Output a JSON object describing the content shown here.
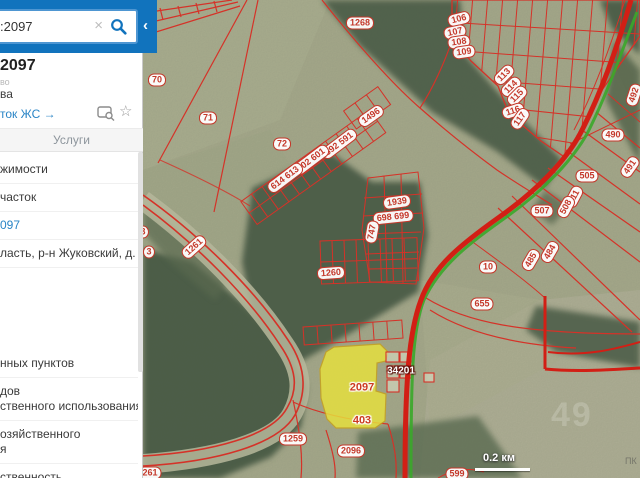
{
  "sidebar": {
    "search": {
      "value": ":2097",
      "clear_icon": "×",
      "collapse_icon": "‹"
    },
    "result": {
      "title": "2097",
      "meta": "во",
      "line2": "ва",
      "link": "ток ЖС →",
      "star_icon": "☆"
    },
    "tab": "Услуги",
    "rows_top": [
      {
        "lines": [
          "жимости"
        ]
      },
      {
        "lines": [
          "часток"
        ]
      },
      {
        "lines": [
          "097"
        ],
        "link": true
      },
      {
        "lines": [
          "ласть, р-н Жуковский, д."
        ]
      }
    ],
    "rows_bottom": [
      {
        "lines": [
          "нных пунктов"
        ]
      },
      {
        "lines": [
          "дов",
          "ственного использования"
        ]
      },
      {
        "lines": [
          "озяйственного",
          "я"
        ]
      },
      {
        "lines": [
          "ственность"
        ]
      }
    ]
  },
  "map": {
    "scale": {
      "label": "0.2 км"
    },
    "watermark": {
      "digits": "49",
      "corner": "ПК"
    },
    "colors": {
      "accent_blue": "#1173bd",
      "parcel_red": "#d53228",
      "highlight_yellow": "#e8e23c",
      "road_green": "#3aa82a"
    },
    "labels": [
      {
        "text": "1268",
        "x": 217,
        "y": 23
      },
      {
        "text": "70",
        "x": 14,
        "y": 80
      },
      {
        "text": "71",
        "x": 65,
        "y": 118
      },
      {
        "text": "72",
        "x": 139,
        "y": 144
      },
      {
        "text": "106",
        "x": 316,
        "y": 19,
        "r": -14
      },
      {
        "text": "107",
        "x": 312,
        "y": 32,
        "r": -12
      },
      {
        "text": "108",
        "x": 316,
        "y": 42,
        "r": -8
      },
      {
        "text": "109",
        "x": 321,
        "y": 52,
        "r": -8
      },
      {
        "text": "113",
        "x": 361,
        "y": 75,
        "r": -45
      },
      {
        "text": "114",
        "x": 368,
        "y": 87,
        "r": -45
      },
      {
        "text": "115",
        "x": 374,
        "y": 96,
        "r": -45
      },
      {
        "text": "116",
        "x": 370,
        "y": 111,
        "r": -18
      },
      {
        "text": "117",
        "x": 377,
        "y": 119,
        "r": -55
      },
      {
        "text": "1496",
        "x": 228,
        "y": 116,
        "r": -35
      },
      {
        "text": "592 591",
        "x": 196,
        "y": 144,
        "r": -37
      },
      {
        "text": "602 601",
        "x": 168,
        "y": 160,
        "r": -37
      },
      {
        "text": "614 613",
        "x": 142,
        "y": 178,
        "r": -37
      },
      {
        "text": "1939",
        "x": 254,
        "y": 202,
        "r": -8
      },
      {
        "text": "698 699",
        "x": 250,
        "y": 217,
        "r": -6
      },
      {
        "text": "747",
        "x": 229,
        "y": 232,
        "r": -80
      },
      {
        "text": "1260",
        "x": 188,
        "y": 273,
        "r": -4
      },
      {
        "text": "1261",
        "x": 51,
        "y": 247,
        "r": -42
      },
      {
        "text": "3",
        "x": 6,
        "y": 252,
        "circle": true
      },
      {
        "text": "3",
        "x": 0,
        "y": 232,
        "circle": true
      },
      {
        "text": "490",
        "x": 470,
        "y": 135
      },
      {
        "text": "491",
        "x": 487,
        "y": 167,
        "r": -55
      },
      {
        "text": "492",
        "x": 491,
        "y": 95,
        "r": -72
      },
      {
        "text": "505",
        "x": 444,
        "y": 176
      },
      {
        "text": "511",
        "x": 431,
        "y": 197,
        "r": -62
      },
      {
        "text": "508",
        "x": 423,
        "y": 207,
        "r": -62
      },
      {
        "text": "507",
        "x": 399,
        "y": 211
      },
      {
        "text": "484",
        "x": 407,
        "y": 252,
        "r": -60
      },
      {
        "text": "485",
        "x": 388,
        "y": 260,
        "r": -60
      },
      {
        "text": "10",
        "x": 345,
        "y": 267
      },
      {
        "text": "655",
        "x": 339,
        "y": 304
      },
      {
        "text": "2097",
        "x": 219,
        "y": 388,
        "type": "hl"
      },
      {
        "text": "403",
        "x": 219,
        "y": 421,
        "type": "hl"
      },
      {
        "text": "34201",
        "x": 258,
        "y": 371,
        "type": "road"
      },
      {
        "text": "1259",
        "x": 150,
        "y": 439
      },
      {
        "text": "2096",
        "x": 208,
        "y": 451
      },
      {
        "text": "261",
        "x": 7,
        "y": 473
      },
      {
        "text": "599",
        "x": 314,
        "y": 474
      }
    ]
  }
}
